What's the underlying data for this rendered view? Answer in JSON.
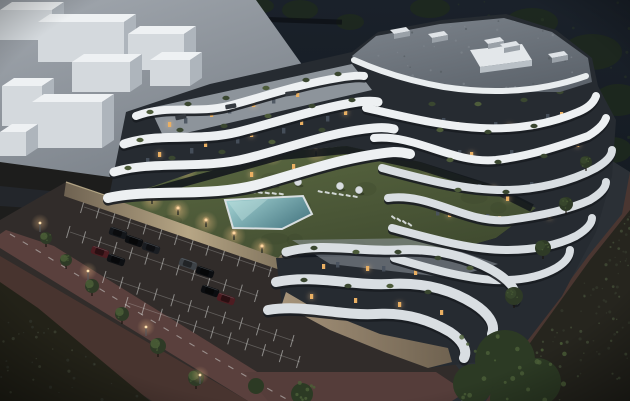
{
  "scene": {
    "description": "Aerial dusk 3D architectural rendering: curved white multi-tier apartment complex with planted roof terraces around a landscaped courtyard with swimming pool, beige perimeter wall, car park with marked bays, perimeter streets and dark hillside vegetation",
    "time_of_day": "dusk",
    "inventory": {
      "apartment_wings": 3,
      "roof_hvac_units": 5,
      "pools": 1,
      "pool_umbrellas": 5,
      "sun_lounger_rows": 3,
      "courtyard_bollard_lights": 9,
      "parked_cars": 9,
      "parking_lamp_posts": 4,
      "parking_trees": 6,
      "street_trees": 4,
      "neighbor_building_blocks": 8
    }
  },
  "palette": {
    "sky_top": "#1a212a",
    "sky_bottom": "#0f141a",
    "hill_tree": "#1e2a1c",
    "neighbor_hi": "#a2a8af",
    "neighbor_lo": "#767d85",
    "cube_top": "#eef1f3",
    "cube_front": "#d4d9dd",
    "cube_side": "#aeb5bc",
    "building_white": "#edf0f2",
    "building_white_dim": "#d9dee2",
    "facade_dark": "#262b31",
    "facade_darker": "#14181d",
    "roof_hi": "#7d848c",
    "roof_lo": "#5d646c",
    "terrace_deck": "#a8afb6",
    "podium": "#9d8b72",
    "lawn_hi": "#5f6d44",
    "lawn_lo": "#3f4a2f",
    "pool_hi": "#a8d8d8",
    "pool_lo": "#4f7f89",
    "pool_deck": "#d8dee0",
    "wall_lit": "#b7a685",
    "wall_shadow": "#6e6251",
    "parking_asphalt": "#312c2a",
    "stall_line": "#d8d9d6",
    "drive_aisle": "#5a403d",
    "red_sidewalk": "#48342f",
    "scrub_left": "#232218",
    "scrub_right": "#26251e",
    "road": "#2b3036",
    "road_sidewalk": "#3a3e44",
    "road_red_edge": "#4a3631",
    "ground_dark": "#1d1d1c",
    "tree_dark": "#2e3a26",
    "tree_lit": "#4c6038",
    "trunk": "#1b1510",
    "window_warm": "#eab063",
    "window_cool": "#49525e",
    "glow": "#ffc98c",
    "plant_green": "#3a4730",
    "plant_green2": "#4d5c3a",
    "car_black": "#0b0d10",
    "car_dark": "#14171b",
    "car_gray": "#3d4247",
    "car_red": "#4d1c21"
  }
}
